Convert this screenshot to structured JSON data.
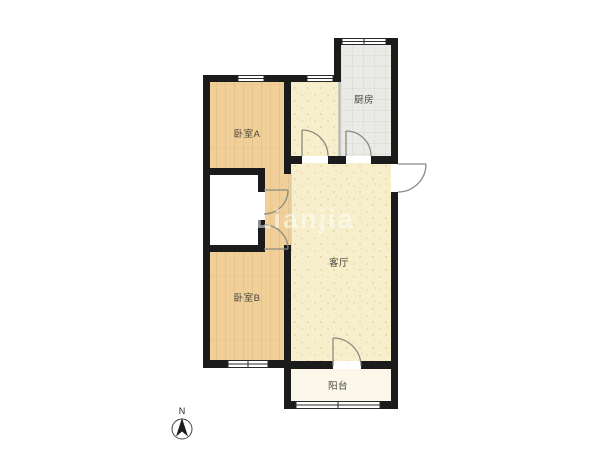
{
  "page": {
    "background": "#ffffff"
  },
  "colors": {
    "wall": "#1b1b1b",
    "wood_floor": "#f0d098",
    "wood_grain": "#dfba7e",
    "living_floor": "#f7eecb",
    "living_speckle": "#e8d7a2",
    "kitchen_floor": "#eaeae7",
    "kitchen_grid": "#d8d8d2",
    "balcony_floor": "#fbf7ea",
    "bathroom_floor": "#ffffff",
    "label_text": "#45453c"
  },
  "rooms": {
    "bedroom_a": {
      "label": "卧室A"
    },
    "bedroom_b": {
      "label": "卧室B"
    },
    "kitchen": {
      "label": "厨房"
    },
    "living_room": {
      "label": "客厅"
    },
    "balcony": {
      "label": "阳台"
    }
  },
  "compass": {
    "label": "N"
  },
  "watermark": {
    "text": "Lianjia"
  }
}
